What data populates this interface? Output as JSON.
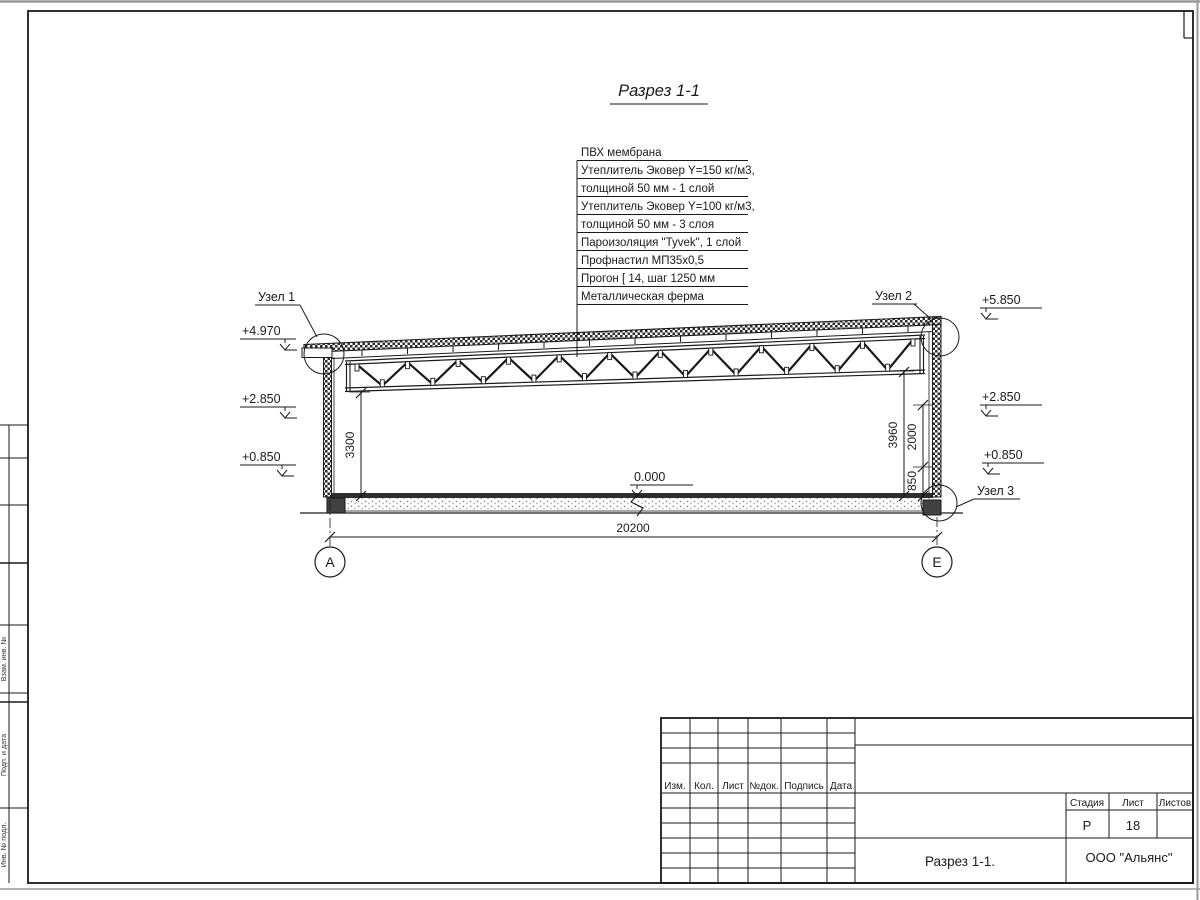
{
  "drawing": {
    "title": "Разрез 1-1",
    "callouts": [
      "ПВХ мембрана",
      "Утеплитель Эковер Y=150 кг/м3,",
      "толщиной 50 мм - 1 слой",
      "Утеплитель Эковер Y=100 кг/м3,",
      "толщиной 50 мм - 3 слоя",
      "Пароизоляция \"Tyvek\", 1 слой",
      "Профнастил МП35х0,5",
      "Прогон [ 14, шаг 1250 мм",
      "Металлическая ферма"
    ],
    "node_labels": {
      "node1": "Узел 1",
      "node2": "Узел 2",
      "node3": "Узел 3"
    },
    "elevations": {
      "left_top": "+4.970",
      "left_mid": "+2.850",
      "left_low": "+0.850",
      "right_top": "+5.850",
      "right_mid": "+2.850",
      "right_low": "+0.850",
      "zero": "0.000"
    },
    "dimensions": {
      "span": "20200",
      "left_height": "3300",
      "right_height": "3960",
      "right_upper": "2000",
      "right_lower": "850"
    },
    "axes": {
      "left": "А",
      "right": "Е"
    }
  },
  "title_block": {
    "col_izm": "Изм.",
    "col_kol": "Кол.",
    "col_list": "Лист",
    "col_ndok": "№док.",
    "col_podpis": "Подпись",
    "col_data": "Дата",
    "stage_label": "Стадия",
    "sheet_label": "Лист",
    "sheets_label": "Листов",
    "stage": "Р",
    "sheet_number": "18",
    "sheets_total": "",
    "drawing_name": "Разрез 1-1.",
    "company": "ООО \"Альянс\""
  },
  "margin_labels": {
    "vzam": "Взам. инв. №",
    "podp": "Подп. и дата",
    "inv": "Инв. № подл."
  }
}
